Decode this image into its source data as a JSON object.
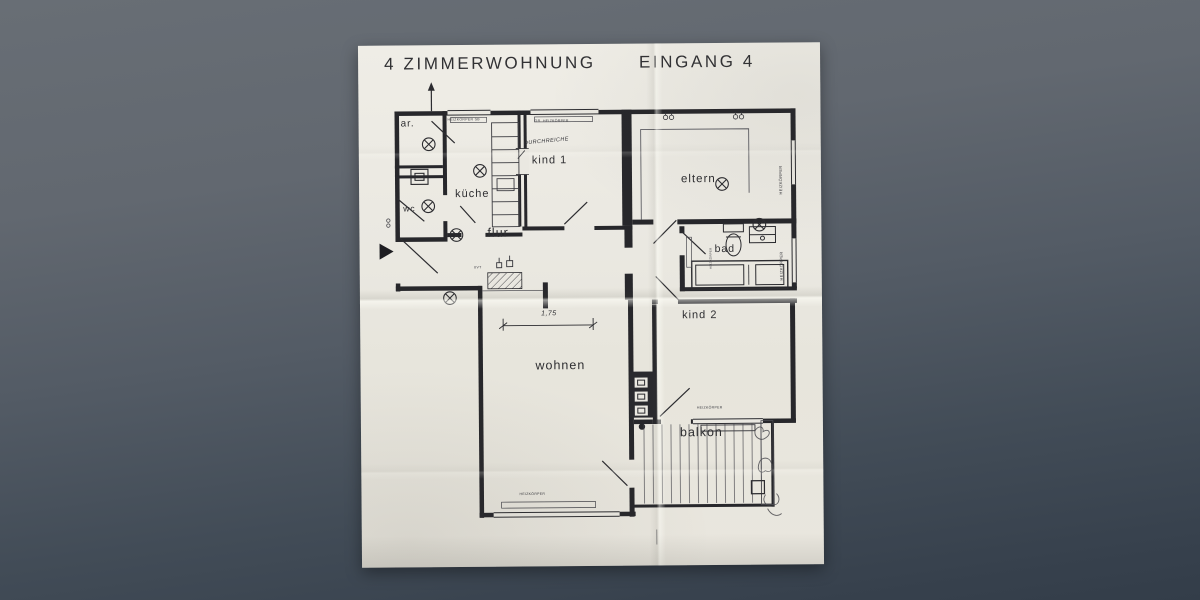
{
  "plan": {
    "title": {
      "left": "4 ZIMMERWOHNUNG",
      "right": "EINGANG 4"
    },
    "rooms": [
      {
        "id": "ar",
        "label": "ar."
      },
      {
        "id": "wc",
        "label": "wc"
      },
      {
        "id": "kueche",
        "label": "küche"
      },
      {
        "id": "kind1",
        "label": "kind 1"
      },
      {
        "id": "flur",
        "label": "flur"
      },
      {
        "id": "eltern",
        "label": "eltern"
      },
      {
        "id": "bad",
        "label": "bad"
      },
      {
        "id": "kind2",
        "label": "kind 2"
      },
      {
        "id": "wohnen",
        "label": "wohnen"
      },
      {
        "id": "balkon",
        "label": "balkon"
      }
    ],
    "annotations": {
      "durchreiche": "DURCHREICHE",
      "uvt": "UVT",
      "dimension": "1,75",
      "heizkoerper": "HEIZKÖRPER",
      "gr_heizkoerper": "GR. HEIZKÖRPER",
      "heizkoerper_sb": "HEIZKÖRPER SB"
    },
    "icons": {
      "ceiling_light": "circle-x",
      "north_arrow": "up-arrow",
      "entrance_marker": "right-triangle"
    },
    "colors": {
      "paper": "#eae8e1",
      "ink": "#2c2c30",
      "backdrop_top": "#686e75",
      "backdrop_bottom": "#333d49"
    }
  }
}
